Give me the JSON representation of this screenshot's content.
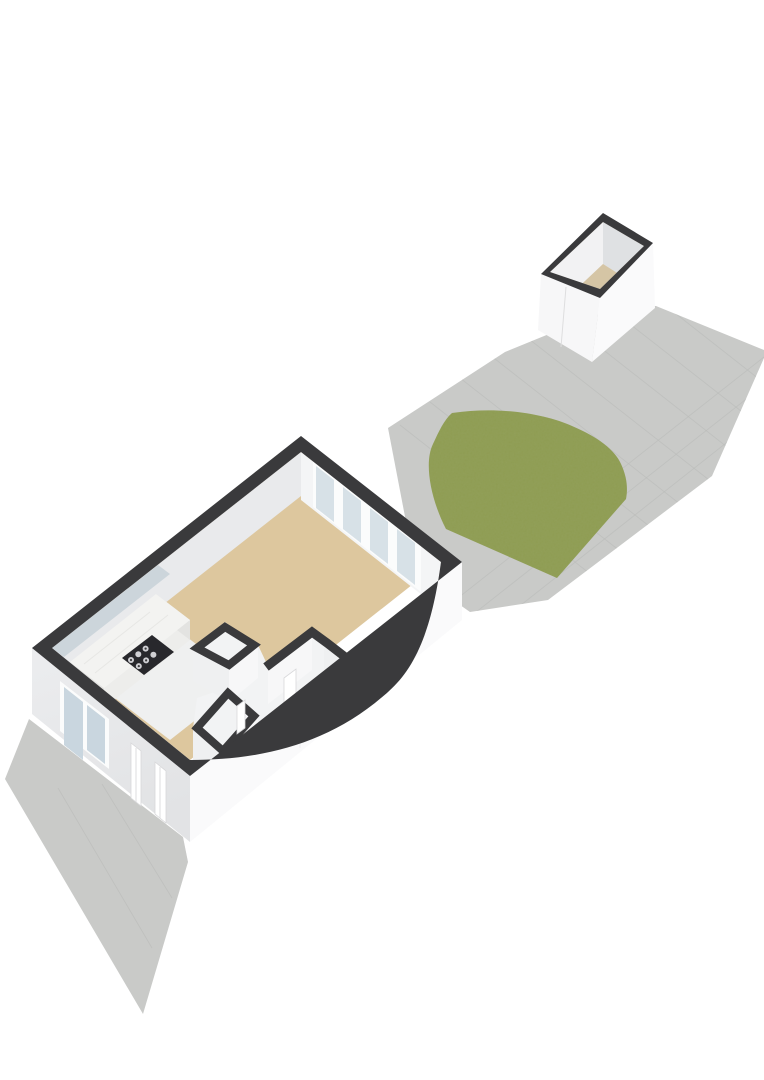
{
  "meta": {
    "view": "isometric-3d-floorplan-render",
    "description": "3D floor plan of a single-storey studio dwelling with paved garden, lawn and detached storage shed",
    "text_visible": "none"
  },
  "scene": {
    "main_house": {
      "rooms": [
        "living-room",
        "kitchen",
        "bathroom",
        "toilet",
        "hallway"
      ],
      "features": [
        "four-panel-glass-sliding-door",
        "kitchen-counter-with-cooktop",
        "facade-windows",
        "facade-doors",
        "interior-partition-walls"
      ]
    },
    "garden": {
      "features": [
        "paved-terrace-with-tile-grid",
        "rounded-lawn-patch",
        "paved-strip-along-facade"
      ]
    },
    "shed": {
      "features": [
        "open-top-view",
        "tan-floor",
        "door-seam-on-side-wall"
      ]
    }
  },
  "palette": {
    "bg": "#ffffff",
    "pave": "#c9cac8",
    "paveLine": "#bbbcba",
    "grass": "#8e9c52",
    "grassGrain": "#5d6a2f",
    "rim": "#3a3a3c",
    "floorTan": "#ddc79e",
    "shedFloor": "#d5c5a5",
    "kitchenFloor": "#eff0f0",
    "whiteArea": "#f2f3f4",
    "innerFaceNW": "#e9eaec",
    "wallFaceNE": "#f4f5f6",
    "wallFaceLit": "#f7f7f8",
    "wallFaceMid": "#eff0f1",
    "facadeSW": "#e8e9eb",
    "facadeSE": "#fafafb",
    "frame": "#fbfcfc",
    "glass": "#d7e1e7",
    "glassBlue": "#c9d6df",
    "blueStrip": "#ccd5db",
    "marble": "#f3f3f1",
    "counterFront": "#ededeb",
    "counterEnd": "#e3e3e1",
    "cooktop": "#28282c",
    "burner": "#cfcfd3",
    "doorLeaf": "#ffffff",
    "doorEdge": "#d8d8da",
    "seam": "#dededf",
    "seamFaint": "#efeff0",
    "marbleVein": "#e4e4e1",
    "shedInnerLeft": "#f2f2f3",
    "shedInnerRight": "#dfe1e3"
  }
}
